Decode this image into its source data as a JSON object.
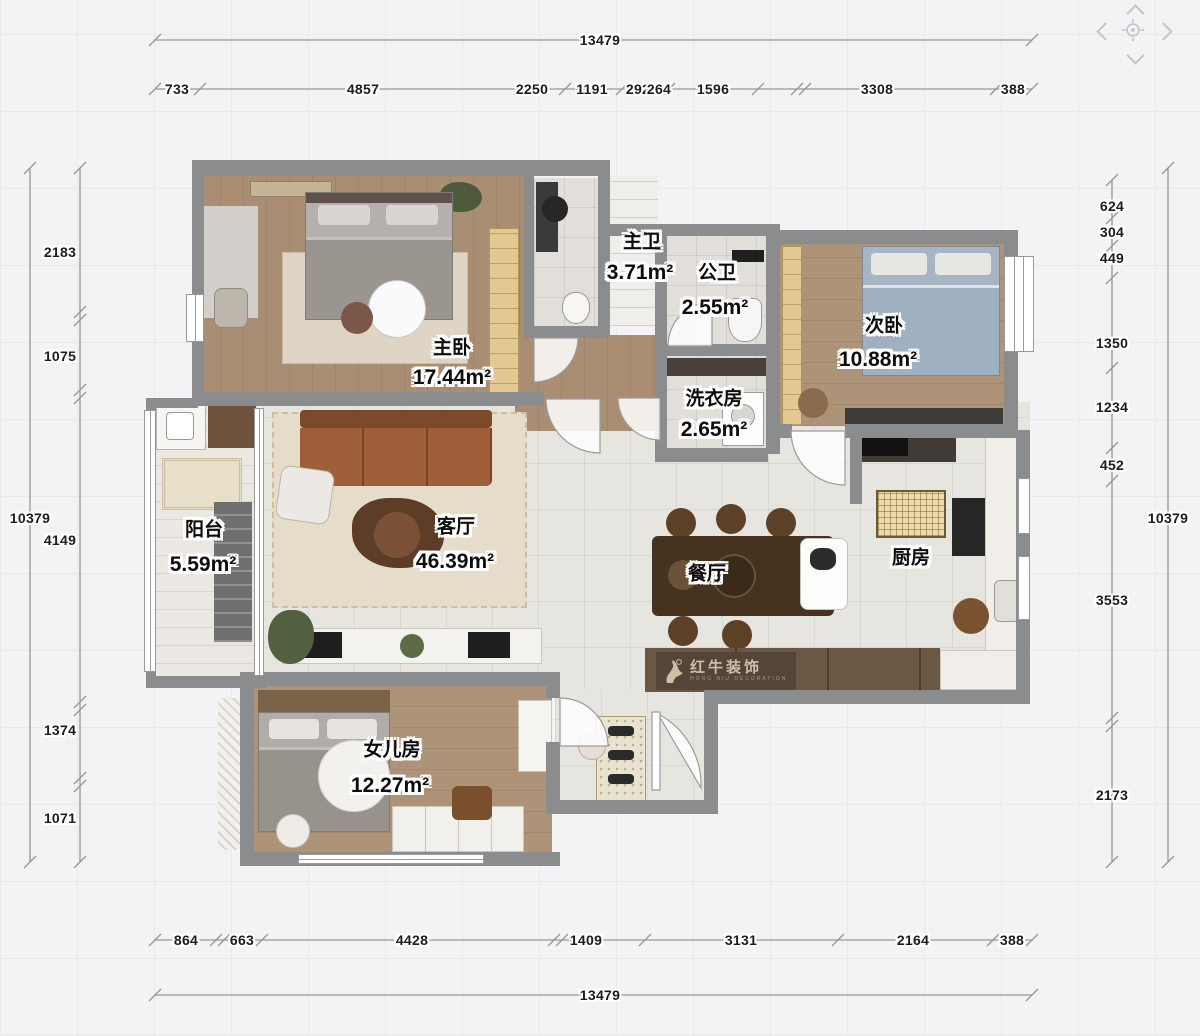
{
  "canvas": {
    "background": "#f3f3f5",
    "grid_color": "#e9e9ec",
    "wall_color": "#8a8c8e",
    "dimension_line_color": "#97979b",
    "label_text_color": "#0d0d0d"
  },
  "pan_control": {
    "up_icon": "chevron-up",
    "down_icon": "chevron-down",
    "left_icon": "chevron-left",
    "right_icon": "chevron-right",
    "center_icon": "crosshair-target"
  },
  "rooms": [
    {
      "name": "主卧",
      "area": "17.44m²"
    },
    {
      "name": "主卫",
      "area": "3.71m²"
    },
    {
      "name": "公卫",
      "area": "2.55m²"
    },
    {
      "name": "次卧",
      "area": "10.88m²"
    },
    {
      "name": "洗衣房",
      "area": "2.65m²"
    },
    {
      "name": "客厅",
      "area": "46.39m²"
    },
    {
      "name": "餐厅"
    },
    {
      "name": "厨房"
    },
    {
      "name": "阳台",
      "area": "5.59m²"
    },
    {
      "name": "女儿房",
      "area": "12.27m²"
    }
  ],
  "dimensions": {
    "top": {
      "total": "13479",
      "segments": [
        "733",
        "4857",
        "2250",
        "1191",
        "292",
        "264",
        "1596",
        "3308",
        "388"
      ]
    },
    "bottom": {
      "total": "13479",
      "segments": [
        "864",
        "663",
        "4428",
        "1409",
        "3131",
        "2164",
        "388"
      ]
    },
    "left": {
      "total": "10379",
      "segments": [
        "2183",
        "1075",
        "4149",
        "1374",
        "1071"
      ]
    },
    "right": {
      "total": "10379",
      "segments": [
        "624",
        "304",
        "449",
        "1350",
        "1234",
        "452",
        "3553",
        "2173"
      ]
    }
  },
  "watermark": {
    "brand": "红牛装饰",
    "caption": "HONG NIU DECORATION"
  }
}
